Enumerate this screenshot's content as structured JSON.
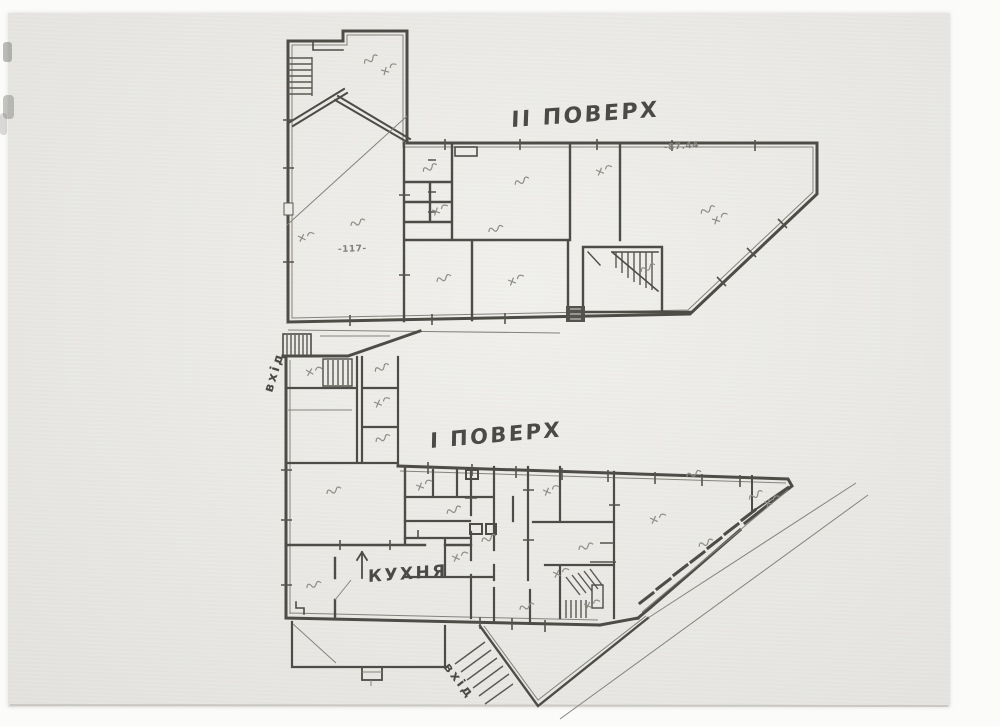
{
  "document": {
    "type": "scanned hand-drawn floor plan",
    "floor2": {
      "title": "II ПОВЕРХ",
      "dim_top_right": "-87.44"
    },
    "floor1": {
      "title": "I ПОВЕРХ",
      "kitchen_label": "КУХНЯ",
      "entrance_left_label": "вхід",
      "entrance_bottom_label": "вхід",
      "dim_left_wing": "-117-"
    },
    "colors": {
      "paper": "#ecebe7",
      "margin": "#fbfbfa",
      "ink_walls": "#4e4c47",
      "pencil_annotations": "#8e8c85",
      "hand_lettering": "#4b4a46"
    }
  }
}
